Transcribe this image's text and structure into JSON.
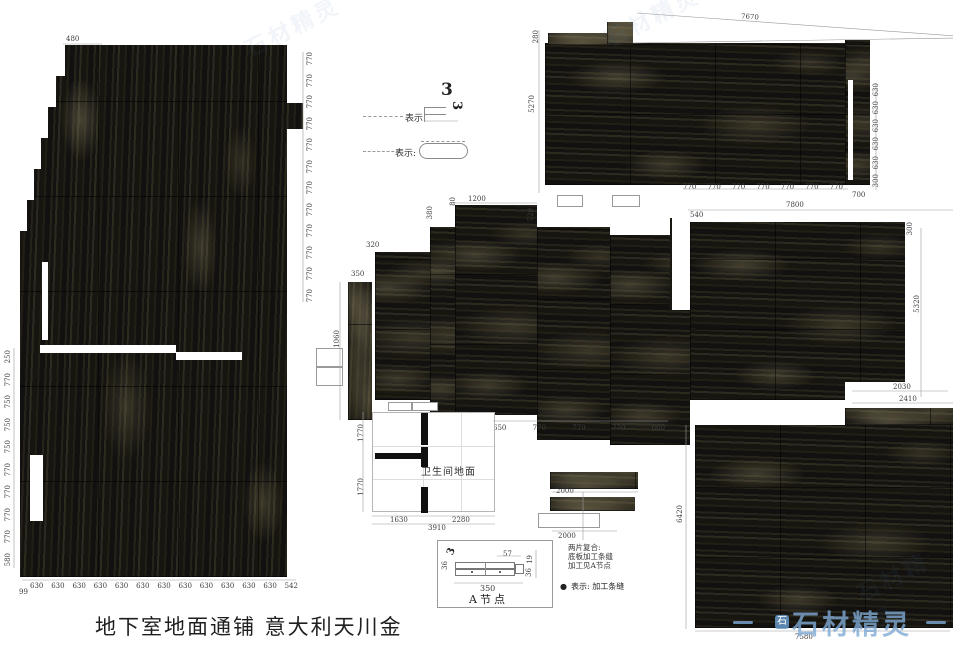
{
  "title": "地下室地面通铺 意大利天川金",
  "legend": {
    "row1": {
      "label": "表示:",
      "sym_top": "3",
      "sym_side": "3"
    },
    "row2": {
      "label": "表示:"
    }
  },
  "left_panel": {
    "top_dim": "480",
    "right_dims": [
      "770",
      "770",
      "770",
      "770",
      "770",
      "770",
      "770",
      "770",
      "770",
      "770",
      "770",
      "770"
    ],
    "left_dims": [
      "250",
      "770",
      "750",
      "750",
      "750",
      "770",
      "770",
      "770",
      "770",
      "580"
    ],
    "bottom_corner": "99",
    "bottom_dims": [
      "630",
      "630",
      "630",
      "630",
      "630",
      "630",
      "630",
      "630",
      "630",
      "630",
      "630",
      "630",
      "542"
    ]
  },
  "top_right_panel": {
    "top_dim": "7670",
    "left_top_dim": "280",
    "left_dim": "5270",
    "bottom_dims": [
      "770",
      "770",
      "770",
      "770",
      "770",
      "770",
      "770"
    ],
    "bottom_right_dim": "700",
    "right_dims": [
      "630",
      "630",
      "630",
      "630",
      "630",
      "300"
    ]
  },
  "middle_panel": {
    "top_dim": "1200",
    "dim_80": "80",
    "dim_380": "380",
    "dim_320": "320",
    "dim_350": "350",
    "dim_1060": "1060",
    "dim_520": "520",
    "bottom_dims": [
      "650",
      "770",
      "770",
      "770",
      "660"
    ]
  },
  "right_panel": {
    "top_dim": "7800",
    "left_top_dim": "540",
    "right_top_dim": "300",
    "right_dim": "5320",
    "notch_dim1": "2030",
    "notch_dim2": "2410"
  },
  "bottom_right_panel": {
    "left_dim": "6420",
    "bottom_dim": "7580"
  },
  "bathroom": {
    "label": "卫生间地面",
    "bottom_dim1": "1630",
    "bottom_dim2": "2280",
    "total_dim": "3910",
    "left_dim1": "1770",
    "left_dim2": "1770"
  },
  "strips": {
    "dim1": "2000",
    "dim2": "2000",
    "rot_dim": "90"
  },
  "notes": {
    "lines": [
      "两片复合:",
      "底板加工条缝",
      "加工见A节点"
    ],
    "bullet_icon": "●",
    "bullet_label": "表示: 加工条缝"
  },
  "node_detail": {
    "label": "A节点",
    "symbol": "3",
    "dim_top": "57",
    "dim_bottom": "350",
    "dim_left": "36",
    "dim_right_top": "19",
    "dim_right_bottom": "36"
  },
  "watermark": {
    "text": "石材精灵",
    "logo_char": "石"
  }
}
